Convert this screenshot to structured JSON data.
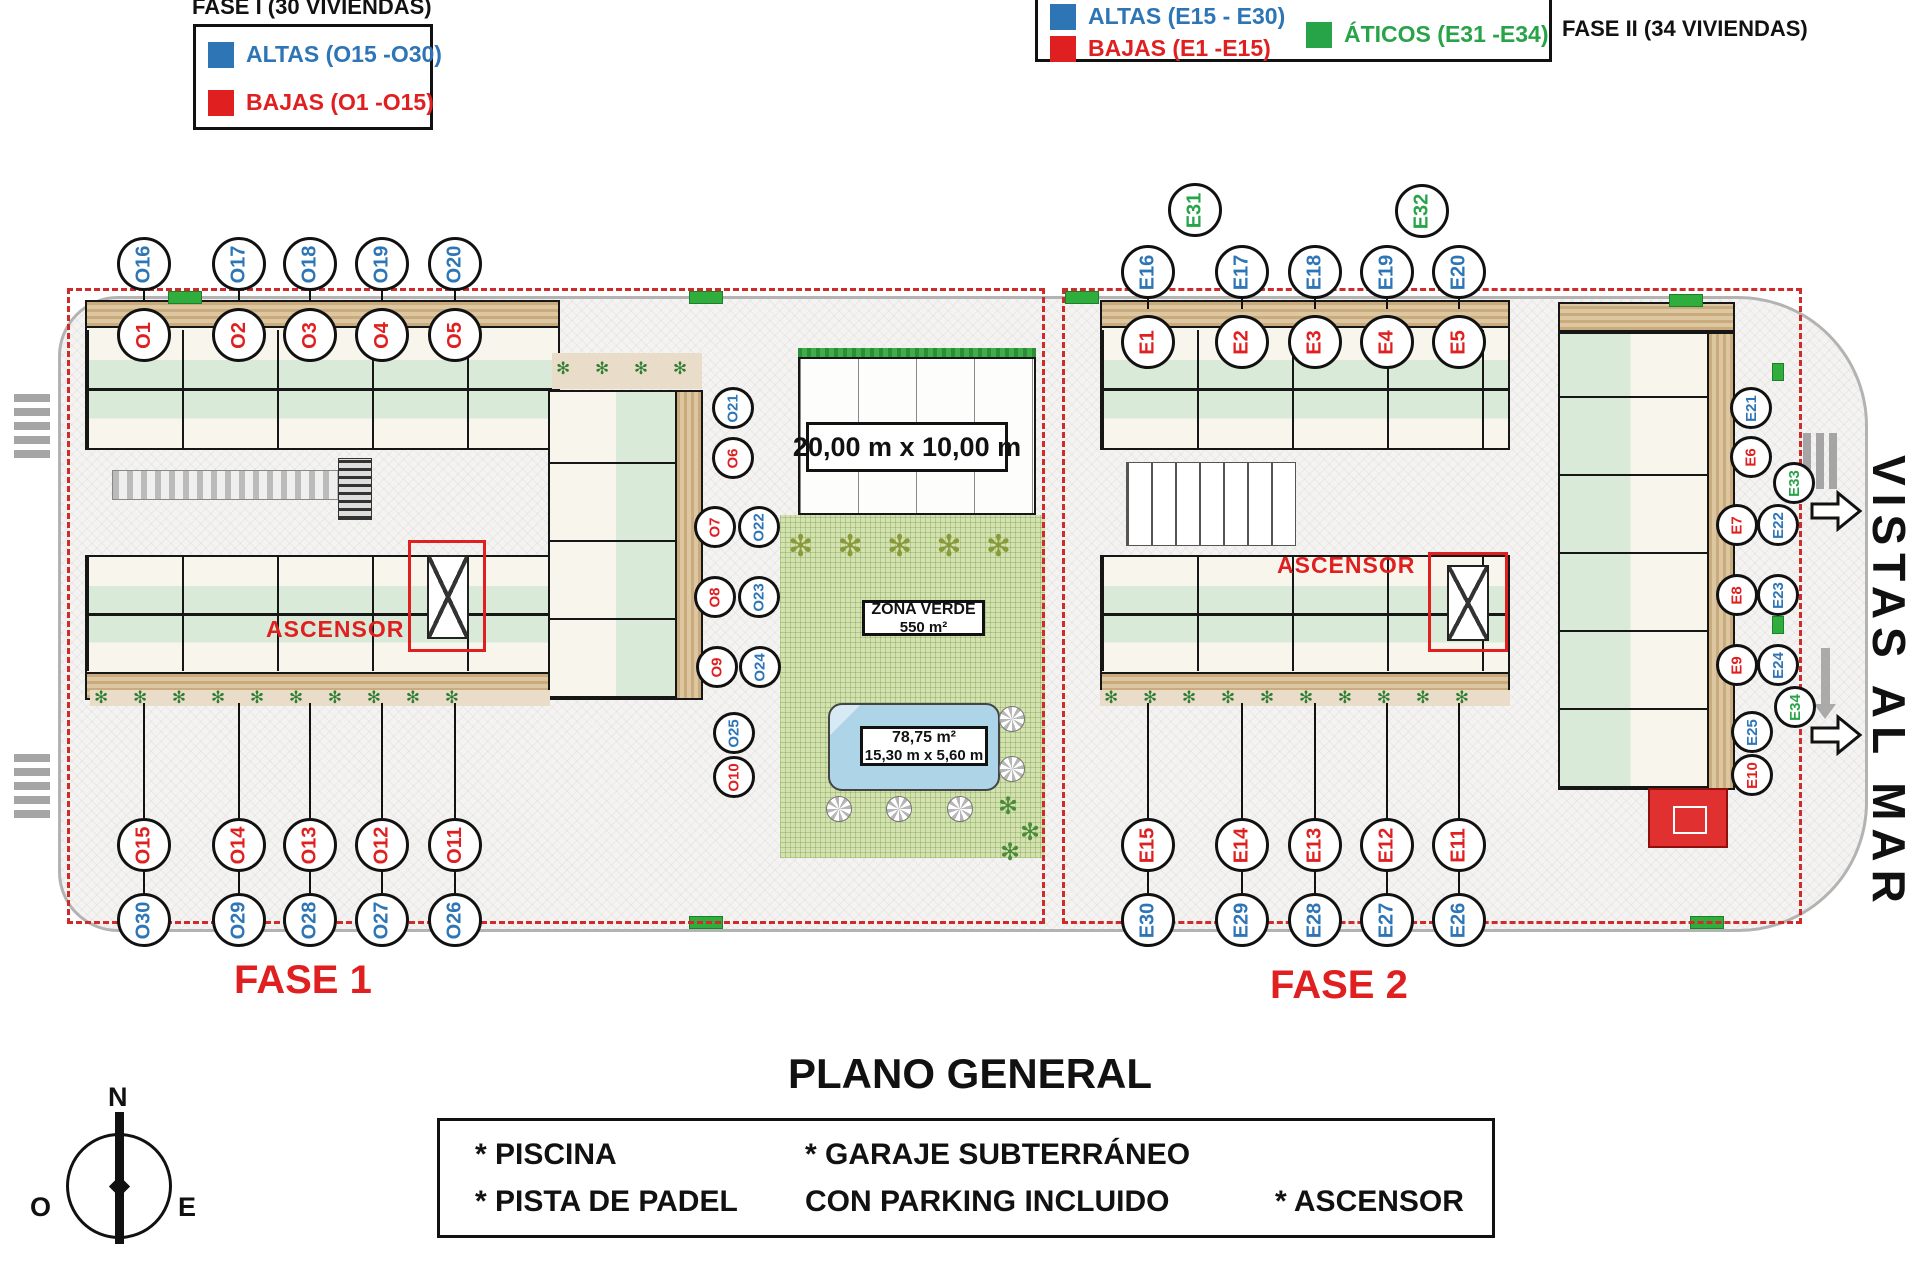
{
  "legend_fase1": {
    "title": "FASE I (30 VIVIENDAS)",
    "items": [
      {
        "label": "ALTAS (O15 -O30)",
        "color": "#2e75b6"
      },
      {
        "label": "BAJAS (O1 -O15)",
        "color": "#e02020"
      }
    ]
  },
  "legend_fase2": {
    "title": "FASE II (34 VIVIENDAS)",
    "items": [
      {
        "label": "ALTAS (E15 - E30)",
        "color": "#2e75b6"
      },
      {
        "label": "BAJAS (E1 -E15)",
        "color": "#e02020"
      },
      {
        "label": "ÁTICOS (E31 -E34)",
        "color": "#27a348"
      }
    ]
  },
  "plan": {
    "fase1_label": "FASE 1",
    "fase2_label": "FASE 2",
    "ascensor_label": "ASCENSOR",
    "vistas_label": "VISTAS AL MAR",
    "padel_dims": "20,00 m x 10,00 m",
    "zona_verde": {
      "line1": "ZONA VERDE",
      "line2": "550 m²"
    },
    "pool": {
      "line1": "78,75 m²",
      "line2": "15,30 m x 5,60 m"
    },
    "colors": {
      "b": "#2e75b6",
      "r": "#e02020",
      "g": "#27a348"
    },
    "units": [
      {
        "id": "O16",
        "x": 144,
        "y": 264,
        "r": 27,
        "c": "b",
        "sd": 10
      },
      {
        "id": "O17",
        "x": 239,
        "y": 264,
        "r": 27,
        "c": "b",
        "sd": 10
      },
      {
        "id": "O18",
        "x": 310,
        "y": 264,
        "r": 27,
        "c": "b",
        "sd": 10
      },
      {
        "id": "O19",
        "x": 382,
        "y": 264,
        "r": 27,
        "c": "b",
        "sd": 10
      },
      {
        "id": "O20",
        "x": 455,
        "y": 264,
        "r": 27,
        "c": "b",
        "sd": 10
      },
      {
        "id": "O1",
        "x": 144,
        "y": 335,
        "r": 27,
        "c": "r"
      },
      {
        "id": "O2",
        "x": 239,
        "y": 335,
        "r": 27,
        "c": "r"
      },
      {
        "id": "O3",
        "x": 310,
        "y": 335,
        "r": 27,
        "c": "r"
      },
      {
        "id": "O4",
        "x": 382,
        "y": 335,
        "r": 27,
        "c": "r"
      },
      {
        "id": "O5",
        "x": 455,
        "y": 335,
        "r": 27,
        "c": "r"
      },
      {
        "id": "O21",
        "x": 733,
        "y": 408,
        "r": 21,
        "c": "b"
      },
      {
        "id": "O6",
        "x": 733,
        "y": 458,
        "r": 21,
        "c": "r"
      },
      {
        "id": "O7",
        "x": 715,
        "y": 527,
        "r": 21,
        "c": "r"
      },
      {
        "id": "O22",
        "x": 759,
        "y": 527,
        "r": 21,
        "c": "b"
      },
      {
        "id": "O8",
        "x": 715,
        "y": 597,
        "r": 21,
        "c": "r"
      },
      {
        "id": "O23",
        "x": 759,
        "y": 597,
        "r": 21,
        "c": "b"
      },
      {
        "id": "O9",
        "x": 717,
        "y": 667,
        "r": 21,
        "c": "r"
      },
      {
        "id": "O24",
        "x": 760,
        "y": 667,
        "r": 21,
        "c": "b"
      },
      {
        "id": "O25",
        "x": 734,
        "y": 733,
        "r": 21,
        "c": "b"
      },
      {
        "id": "O10",
        "x": 734,
        "y": 777,
        "r": 21,
        "c": "r"
      },
      {
        "id": "O15",
        "x": 144,
        "y": 845,
        "r": 27,
        "c": "r",
        "su": 115
      },
      {
        "id": "O14",
        "x": 239,
        "y": 845,
        "r": 27,
        "c": "r",
        "su": 115
      },
      {
        "id": "O13",
        "x": 310,
        "y": 845,
        "r": 27,
        "c": "r",
        "su": 115
      },
      {
        "id": "O12",
        "x": 382,
        "y": 845,
        "r": 27,
        "c": "r",
        "su": 115
      },
      {
        "id": "O11",
        "x": 455,
        "y": 845,
        "r": 27,
        "c": "r",
        "su": 115
      },
      {
        "id": "O30",
        "x": 144,
        "y": 920,
        "r": 27,
        "c": "b",
        "su": 22
      },
      {
        "id": "O29",
        "x": 239,
        "y": 920,
        "r": 27,
        "c": "b",
        "su": 22
      },
      {
        "id": "O28",
        "x": 310,
        "y": 920,
        "r": 27,
        "c": "b",
        "su": 22
      },
      {
        "id": "O27",
        "x": 382,
        "y": 920,
        "r": 27,
        "c": "b",
        "su": 22
      },
      {
        "id": "O26",
        "x": 455,
        "y": 920,
        "r": 27,
        "c": "b",
        "su": 22
      },
      {
        "id": "E31",
        "x": 1195,
        "y": 210,
        "r": 27,
        "c": "g"
      },
      {
        "id": "E32",
        "x": 1422,
        "y": 211,
        "r": 27,
        "c": "g"
      },
      {
        "id": "E16",
        "x": 1148,
        "y": 272,
        "r": 27,
        "c": "b",
        "sd": 10
      },
      {
        "id": "E17",
        "x": 1242,
        "y": 272,
        "r": 27,
        "c": "b",
        "sd": 10
      },
      {
        "id": "E18",
        "x": 1315,
        "y": 272,
        "r": 27,
        "c": "b",
        "sd": 10
      },
      {
        "id": "E19",
        "x": 1387,
        "y": 272,
        "r": 27,
        "c": "b",
        "sd": 10
      },
      {
        "id": "E20",
        "x": 1459,
        "y": 272,
        "r": 27,
        "c": "b",
        "sd": 10
      },
      {
        "id": "E1",
        "x": 1148,
        "y": 342,
        "r": 27,
        "c": "r"
      },
      {
        "id": "E2",
        "x": 1242,
        "y": 342,
        "r": 27,
        "c": "r"
      },
      {
        "id": "E3",
        "x": 1315,
        "y": 342,
        "r": 27,
        "c": "r"
      },
      {
        "id": "E4",
        "x": 1387,
        "y": 342,
        "r": 27,
        "c": "r"
      },
      {
        "id": "E5",
        "x": 1459,
        "y": 342,
        "r": 27,
        "c": "r"
      },
      {
        "id": "E21",
        "x": 1751,
        "y": 408,
        "r": 21,
        "c": "b"
      },
      {
        "id": "E6",
        "x": 1751,
        "y": 457,
        "r": 21,
        "c": "r"
      },
      {
        "id": "E33",
        "x": 1794,
        "y": 483,
        "r": 21,
        "c": "g"
      },
      {
        "id": "E7",
        "x": 1737,
        "y": 525,
        "r": 21,
        "c": "r"
      },
      {
        "id": "E22",
        "x": 1778,
        "y": 525,
        "r": 21,
        "c": "b"
      },
      {
        "id": "E8",
        "x": 1737,
        "y": 595,
        "r": 21,
        "c": "r"
      },
      {
        "id": "E23",
        "x": 1778,
        "y": 595,
        "r": 21,
        "c": "b"
      },
      {
        "id": "E9",
        "x": 1737,
        "y": 665,
        "r": 21,
        "c": "r"
      },
      {
        "id": "E24",
        "x": 1778,
        "y": 665,
        "r": 21,
        "c": "b"
      },
      {
        "id": "E34",
        "x": 1795,
        "y": 707,
        "r": 21,
        "c": "g"
      },
      {
        "id": "E25",
        "x": 1752,
        "y": 732,
        "r": 21,
        "c": "b"
      },
      {
        "id": "E10",
        "x": 1752,
        "y": 775,
        "r": 21,
        "c": "r"
      },
      {
        "id": "E15",
        "x": 1148,
        "y": 845,
        "r": 27,
        "c": "r",
        "su": 115
      },
      {
        "id": "E14",
        "x": 1242,
        "y": 845,
        "r": 27,
        "c": "r",
        "su": 115
      },
      {
        "id": "E13",
        "x": 1315,
        "y": 845,
        "r": 27,
        "c": "r",
        "su": 115
      },
      {
        "id": "E12",
        "x": 1387,
        "y": 845,
        "r": 27,
        "c": "r",
        "su": 115
      },
      {
        "id": "E11",
        "x": 1459,
        "y": 845,
        "r": 27,
        "c": "r",
        "su": 115
      },
      {
        "id": "E30",
        "x": 1148,
        "y": 920,
        "r": 27,
        "c": "b",
        "su": 22
      },
      {
        "id": "E29",
        "x": 1242,
        "y": 920,
        "r": 27,
        "c": "b",
        "su": 22
      },
      {
        "id": "E28",
        "x": 1315,
        "y": 920,
        "r": 27,
        "c": "b",
        "su": 22
      },
      {
        "id": "E27",
        "x": 1387,
        "y": 920,
        "r": 27,
        "c": "b",
        "su": 22
      },
      {
        "id": "E26",
        "x": 1459,
        "y": 920,
        "r": 27,
        "c": "b",
        "su": 22
      }
    ]
  },
  "title": "PLANO GENERAL",
  "amenities": {
    "rows": [
      [
        "* PISCINA",
        "* GARAJE SUBTERRÁNEO",
        ""
      ],
      [
        "* PISTA DE PADEL",
        "CON PARKING INCLUIDO",
        "* ASCENSOR"
      ]
    ]
  },
  "compass": {
    "n": "N",
    "o": "O",
    "e": "E"
  }
}
